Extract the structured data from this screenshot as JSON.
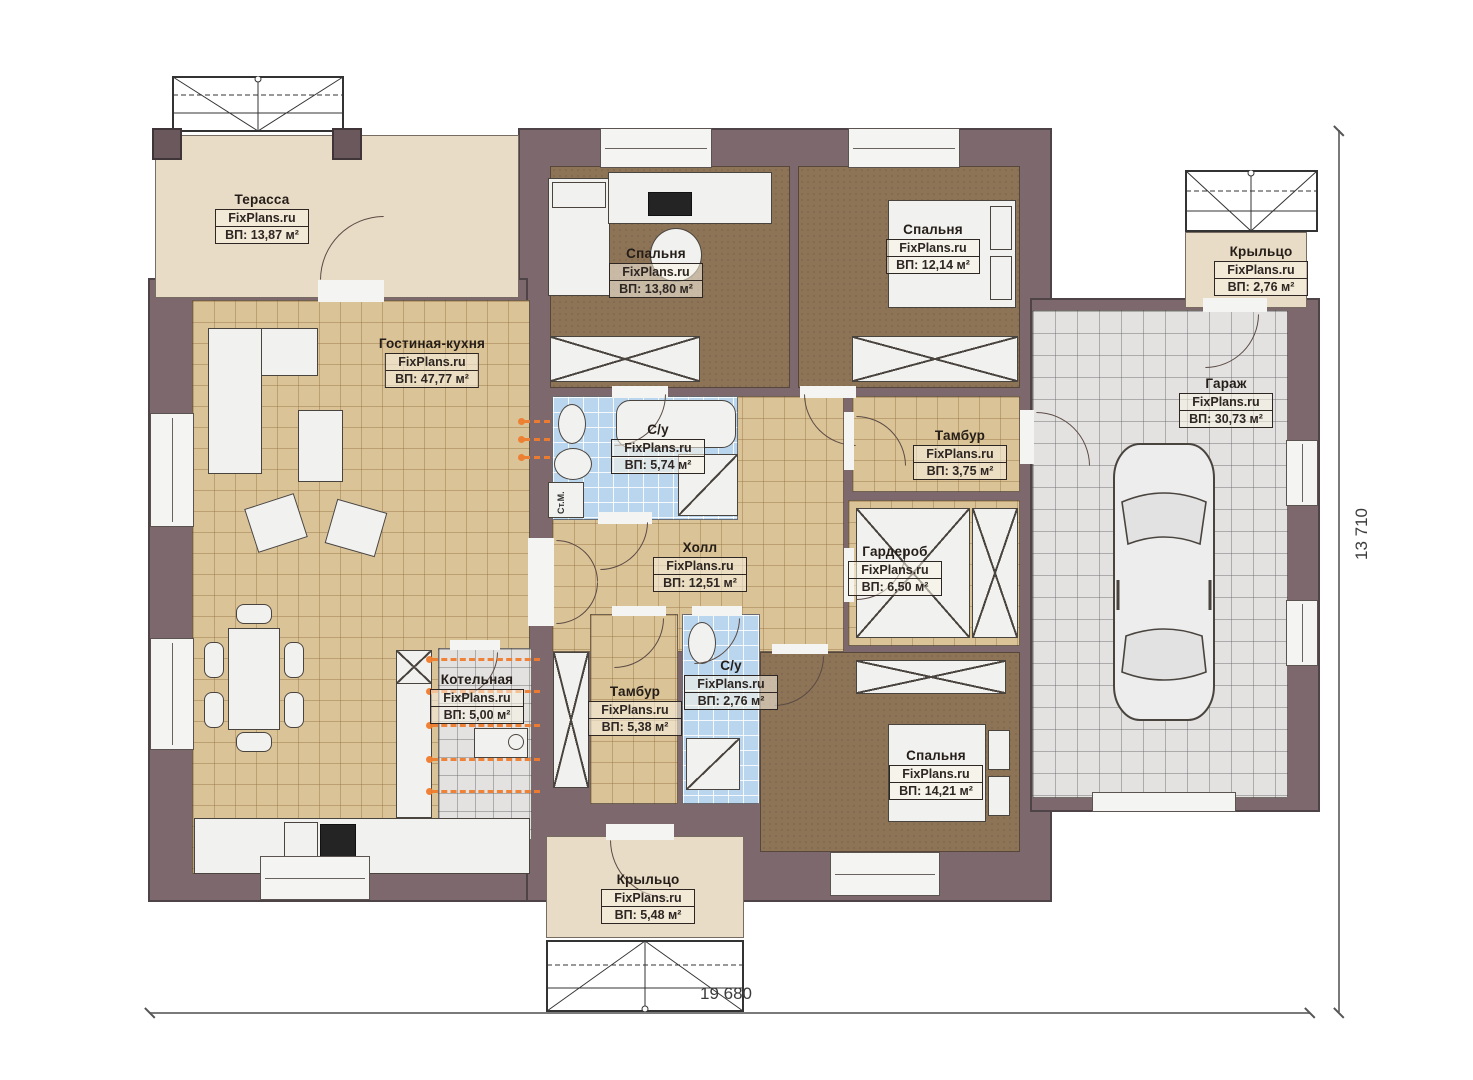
{
  "plan": {
    "watermark": "FixPlans.ru",
    "dimensions": {
      "width_label": "19 680",
      "height_label": "13 710"
    },
    "labels": {
      "washing_machine": "Ст.М."
    },
    "colors": {
      "wall": "#7d696d",
      "floor_living": "#dac397",
      "floor_bedroom": "#8d7457",
      "floor_bath": "#b9d6ee",
      "floor_garage": "#e3e2e1",
      "floor_terrace": "#e9dcc6",
      "radiator": "#f07d2e"
    },
    "rooms": [
      {
        "name": "Терасса",
        "area": "ВП: 13,87 м²"
      },
      {
        "name": "Гостиная-кухня",
        "area": "ВП: 47,77 м²"
      },
      {
        "name": "Спальня",
        "area": "ВП: 13,80 м²"
      },
      {
        "name": "Спальня",
        "area": "ВП: 12,14 м²"
      },
      {
        "name": "Крыльцо",
        "area": "ВП: 2,76 м²"
      },
      {
        "name": "Гараж",
        "area": "ВП: 30,73 м²"
      },
      {
        "name": "С/у",
        "area": "ВП: 5,74 м²"
      },
      {
        "name": "Тамбур",
        "area": "ВП: 3,75 м²"
      },
      {
        "name": "Холл",
        "area": "ВП: 12,51 м²"
      },
      {
        "name": "Гардероб",
        "area": "ВП: 6,50 м²"
      },
      {
        "name": "Котельная",
        "area": "ВП: 5,00 м²"
      },
      {
        "name": "Тамбур",
        "area": "ВП: 5,38 м²"
      },
      {
        "name": "С/у",
        "area": "ВП: 2,76 м²"
      },
      {
        "name": "Спальня",
        "area": "ВП: 14,21 м²"
      },
      {
        "name": "Крыльцо",
        "area": "ВП: 5,48 м²"
      }
    ]
  }
}
